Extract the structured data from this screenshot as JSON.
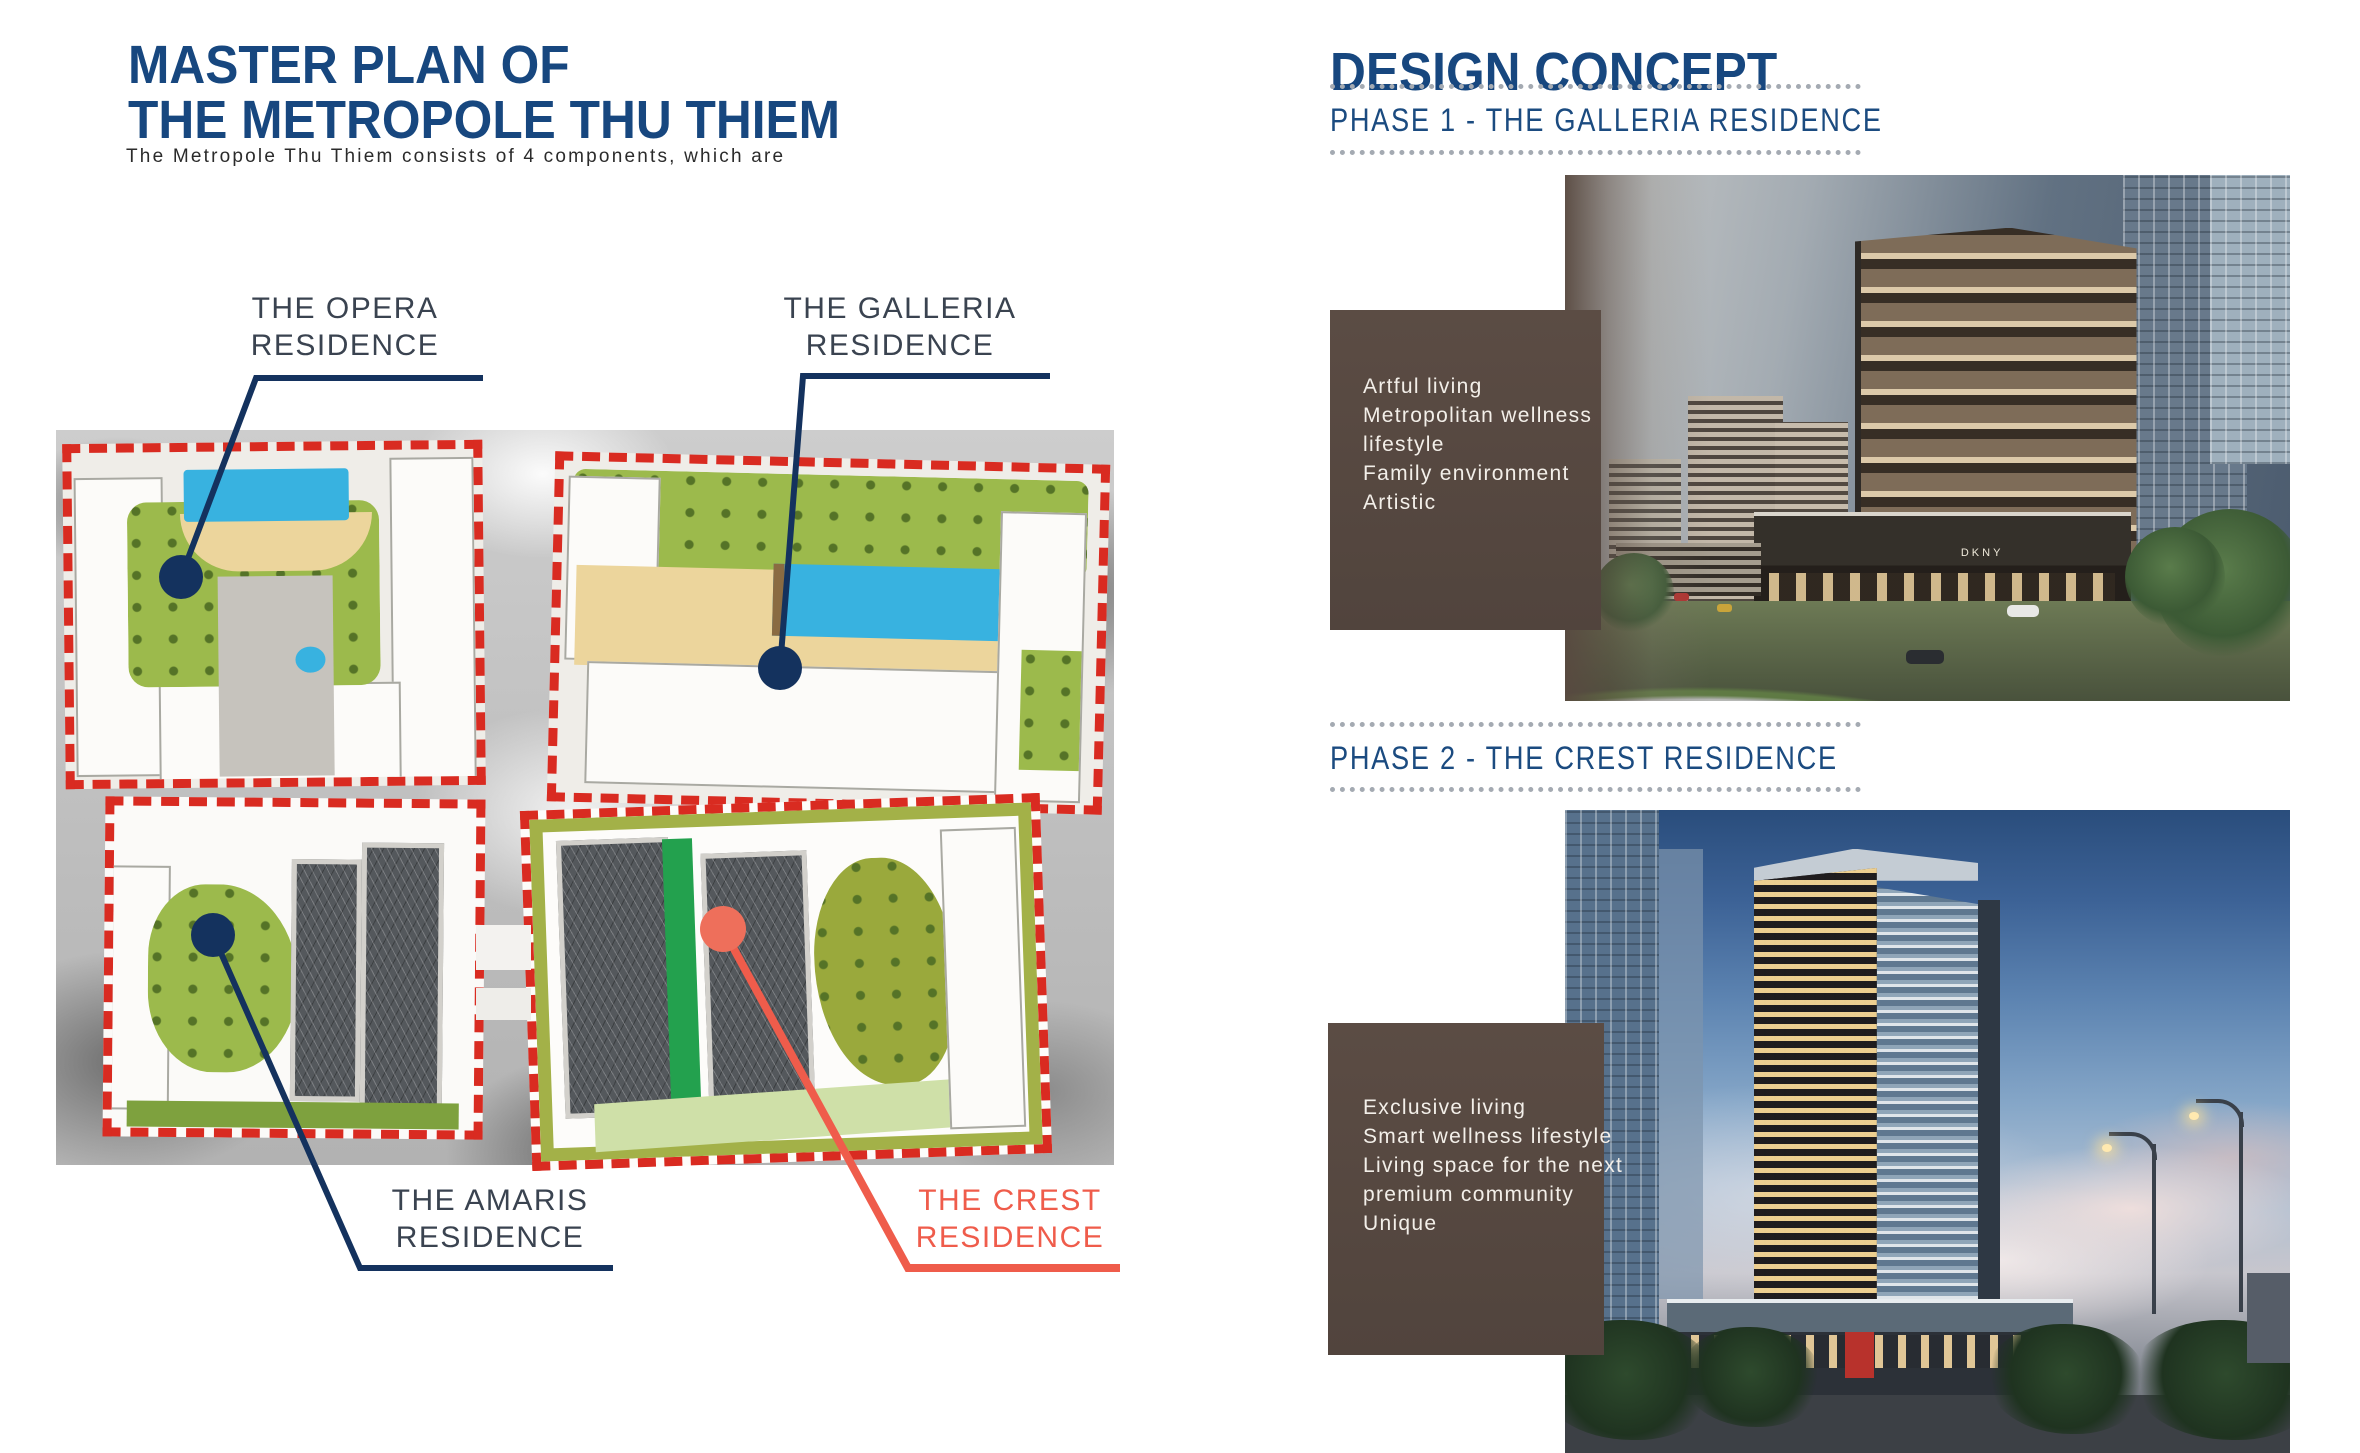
{
  "masterplan": {
    "title_line1": "MASTER PLAN OF",
    "title_line2": "THE METROPOLE THU THIEM",
    "subtitle": "The Metropole Thu Thiem consists of 4 components, which are",
    "callouts": {
      "opera": {
        "lines": [
          "THE OPERA",
          "RESIDENCE"
        ]
      },
      "galleria": {
        "lines": [
          "THE GALLERIA",
          "RESIDENCE"
        ]
      },
      "amaris": {
        "lines": [
          "THE AMARIS",
          "RESIDENCE"
        ]
      },
      "crest": {
        "lines": [
          "THE CREST",
          "RESIDENCE"
        ]
      }
    }
  },
  "design_concept": {
    "title": "DESIGN CONCEPT",
    "phase1": {
      "heading": "PHASE 1 - THE GALLERIA RESIDENCE",
      "features": [
        "Artful living",
        "Metropolitan wellness",
        "lifestyle",
        "Family environment",
        "Artistic"
      ],
      "storefront_sign": "DKNY"
    },
    "phase2": {
      "heading": "PHASE 2 - THE CREST RESIDENCE",
      "features": [
        "Exclusive living",
        "Smart wellness lifestyle",
        "Living space for the next",
        "premium community",
        "Unique"
      ]
    }
  },
  "colors": {
    "heading_navy": "#17477F",
    "phase_navy": "#1B4B80",
    "label_dark": "#3A4350",
    "crest_coral": "#EF5C4B",
    "callout_navy": "#14325E",
    "crest_dot_salmon": "#EE6F5B",
    "plan_boundary_red": "#D92B21",
    "feature_box_brown": "#55463E",
    "dotted_rule_gray": "#A4AAB2"
  }
}
